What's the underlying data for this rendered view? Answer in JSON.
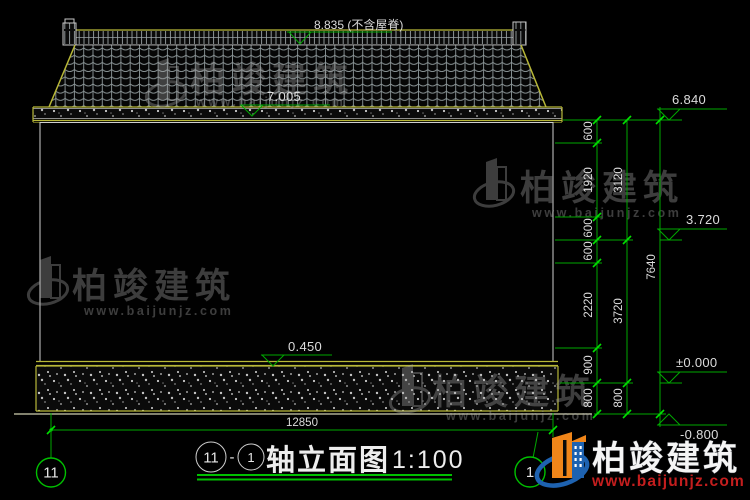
{
  "brand": {
    "name": "柏竣建筑",
    "url": "www.baijunjz.com"
  },
  "levels": {
    "ridge": "8.835 (不含屋脊)",
    "eave": "7.005",
    "parapet": "6.840",
    "mid": "3.720",
    "zero": "±0.000",
    "below": "-0.800",
    "plinth": "0.450"
  },
  "dimensions": {
    "right_inner": [
      "600",
      "1920",
      "600",
      "600",
      "2220",
      "900",
      "800"
    ],
    "right_middle": [
      "3120",
      "3720",
      "800"
    ],
    "right_outer": [
      "7640"
    ],
    "bottom_width": "12850"
  },
  "axis_bubbles": {
    "left": "11",
    "right": "1"
  },
  "title": {
    "circle_left": "11",
    "dash": "-",
    "circle_right": "1",
    "name": "轴立面图",
    "scale": "1:100"
  },
  "colors": {
    "background": "#000000",
    "dimension_green": "#00a800",
    "tick_green": "#00e000",
    "line_yellow": "#b8b838",
    "text_white": "#dcdcdc",
    "watermark_gray": "#a8a8a8",
    "logo_blue": "#1e62b0",
    "logo_orange": "#f08519",
    "logo_url_red": "#c41e1e"
  }
}
